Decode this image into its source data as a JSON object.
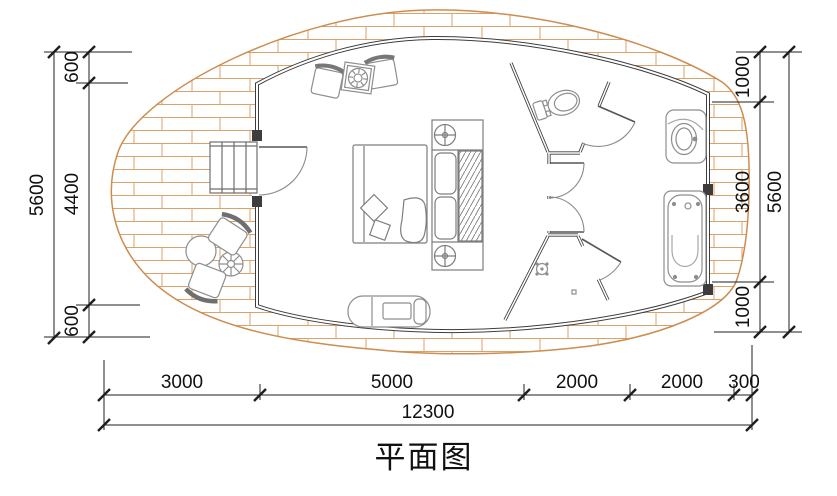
{
  "title": "平面图",
  "dimensions": {
    "left": {
      "total": "5600",
      "segments": [
        "600",
        "4400",
        "600"
      ]
    },
    "right": {
      "total": "5600",
      "segments": [
        "1000",
        "3600",
        "1000"
      ]
    },
    "bottom": {
      "total": "12300",
      "segments": [
        "3000",
        "5000",
        "2000",
        "2000",
        "300"
      ]
    }
  },
  "colors": {
    "wood_plank": "#dca26b",
    "deck_outline": "#cd8d50",
    "wall": "#3d3d3d",
    "furniture": "#8e8e8e",
    "dimension_line": "#1f1f1f",
    "text": "#111111"
  },
  "furniture_icons": [
    "entry-steps",
    "outdoor-armchair-upper",
    "outdoor-armchair-lower",
    "round-table",
    "parasol-table",
    "indoor-armchair-left",
    "indoor-armchair-right",
    "side-table",
    "double-bed",
    "bed-pillow",
    "bed-cushions",
    "nightstand-lamp-top",
    "nightstand-lamp-bottom",
    "wardrobe-rail",
    "chaise-lounge",
    "toilet",
    "shower-head",
    "floor-drain",
    "washbasin",
    "bathtub"
  ]
}
